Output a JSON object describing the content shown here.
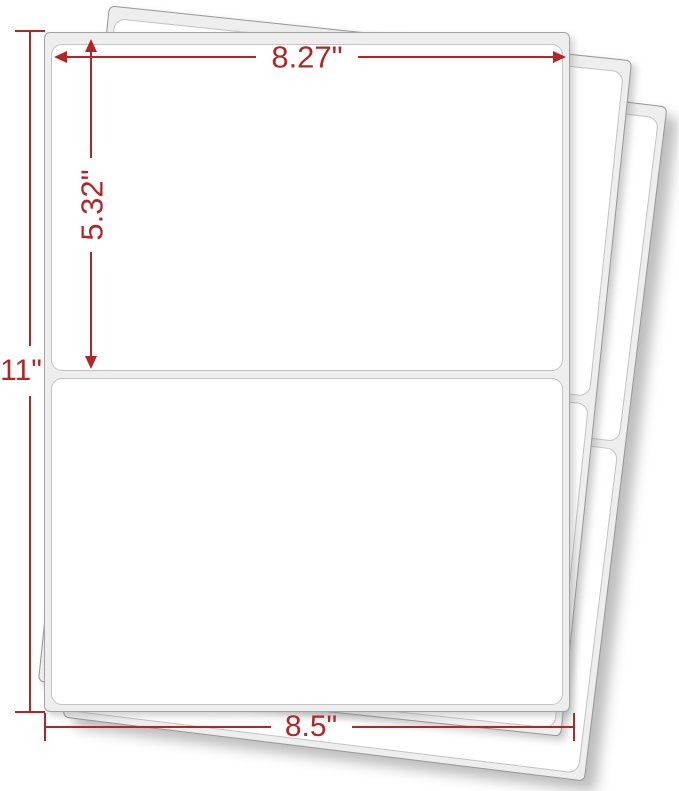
{
  "title": "Half-sheet shipping label sheets with dimension annotations",
  "colors": {
    "accent_red": "#b22626",
    "sheet_fill": "#eeeeee",
    "sheet_edge": "#979797",
    "label_fill": "#ffffff",
    "label_edge": "#c3c3c3"
  },
  "sheets": {
    "count_visible": 3,
    "labels_per_sheet": 2
  },
  "dimensions": {
    "label_width": "8.27\"",
    "label_height": "5.32\"",
    "sheet_height": "11\"",
    "sheet_width": "8.5\""
  }
}
